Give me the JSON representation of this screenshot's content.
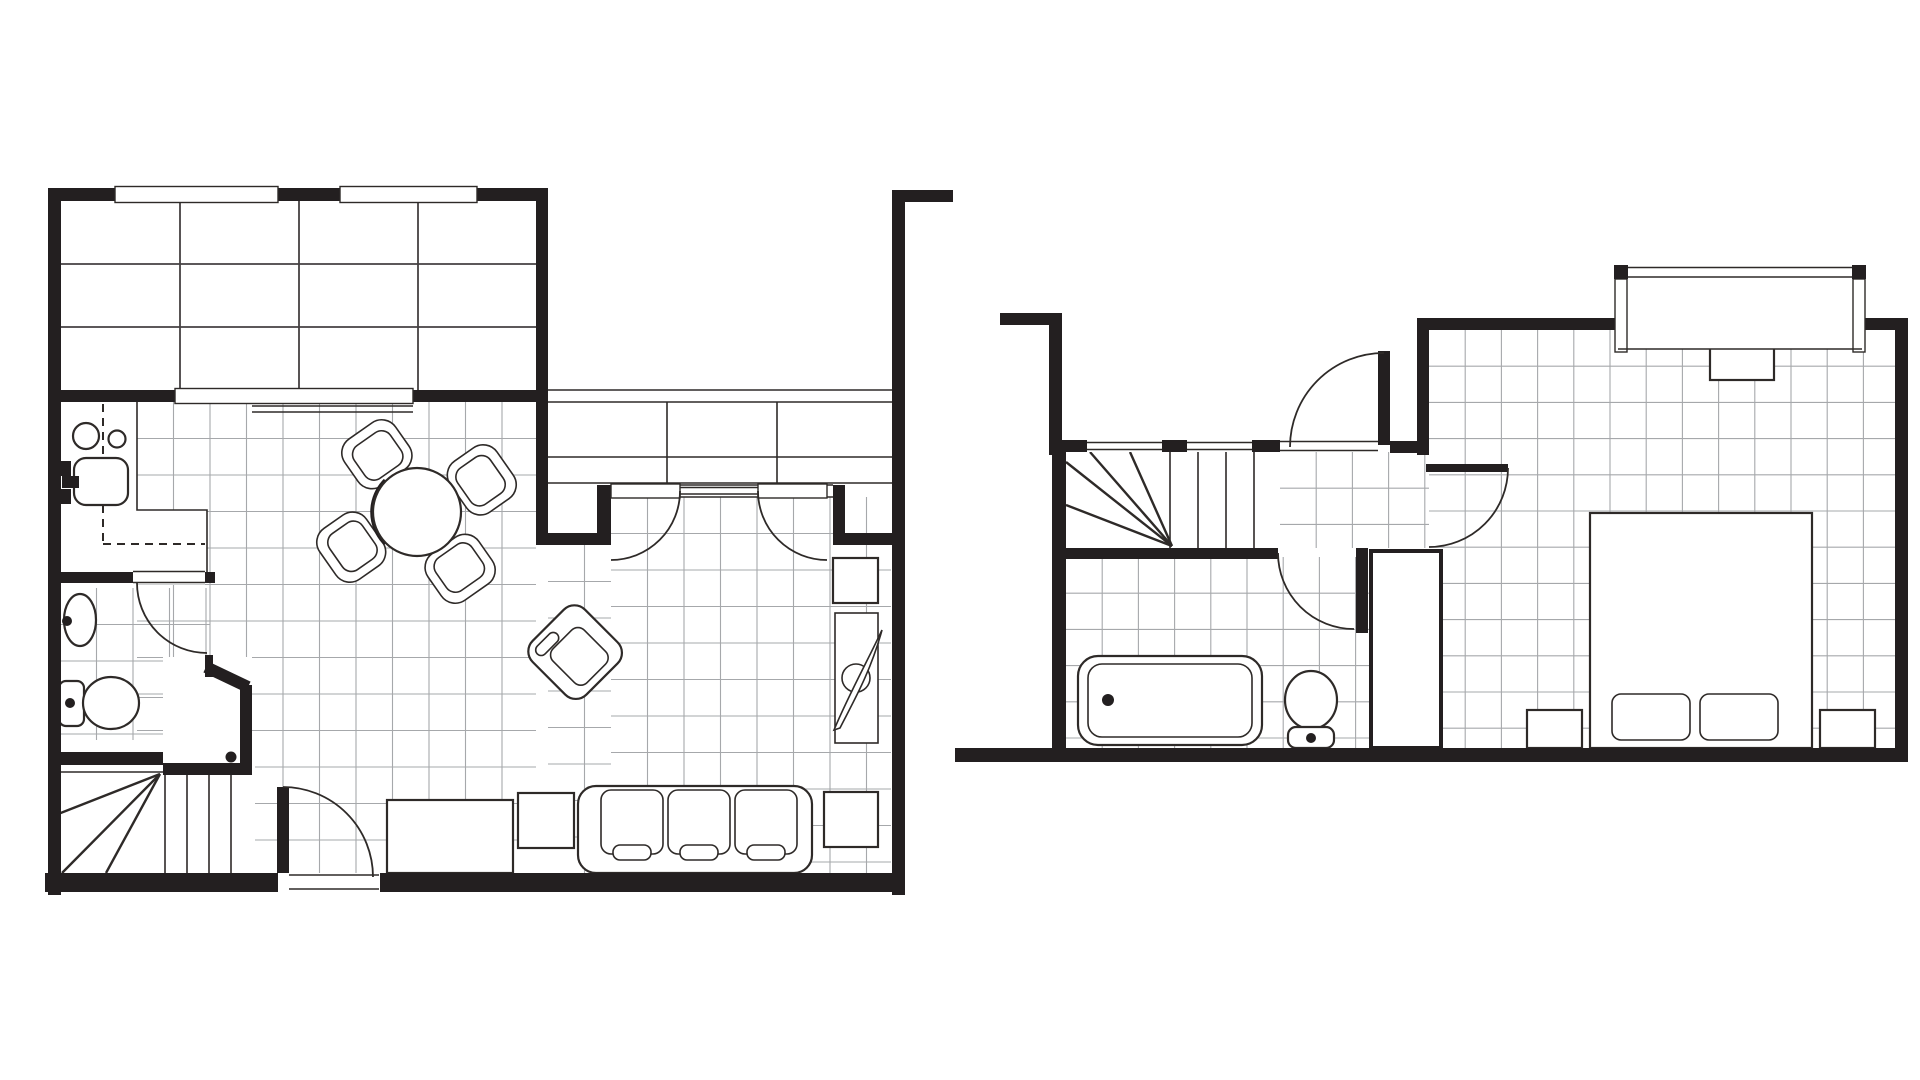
{
  "palette": {
    "background": "#ffffff",
    "wall": "#231f20",
    "line": "#2e2a28",
    "tile": "#a6a8ab",
    "patio_tile": "#454142",
    "fixture_fill": "#ffffff"
  },
  "drawing": {
    "type": "architectural-floor-plan",
    "text_labels": [],
    "floors": [
      {
        "name": "ground-floor",
        "position": "left",
        "rooms": [
          {
            "name": "deck-patio",
            "features": [
              {
                "type": "plank-tile-grid",
                "columns": 4,
                "rows": 3
              },
              {
                "type": "window",
                "count": 2
              },
              {
                "type": "serving-hatch-window",
                "count": 1
              }
            ]
          },
          {
            "name": "kitchen",
            "fixtures": [
              {
                "type": "hob-burner",
                "count": 2
              },
              {
                "type": "kitchen-sink",
                "count": 1
              },
              {
                "type": "wall-faucet",
                "count": 1
              },
              {
                "type": "dashed-appliance-outline",
                "count": 1
              }
            ]
          },
          {
            "name": "bathroom",
            "fixtures": [
              {
                "type": "pedestal-sink",
                "count": 1
              },
              {
                "type": "toilet",
                "count": 1
              },
              {
                "type": "swing-door",
                "count": 1
              }
            ]
          },
          {
            "name": "under-stair-closet",
            "fixtures": [
              {
                "type": "angled-wall",
                "count": 1
              },
              {
                "type": "door-knob-dot",
                "count": 1
              }
            ]
          },
          {
            "name": "winder-staircase",
            "fixtures": [
              {
                "type": "fan-tread",
                "count": 3
              },
              {
                "type": "straight-tread",
                "count": 3
              }
            ]
          },
          {
            "name": "living-dining-room",
            "fixtures": [
              {
                "type": "round-dining-table",
                "count": 1
              },
              {
                "type": "dining-chair",
                "count": 4
              },
              {
                "type": "rotated-armchair",
                "count": 1
              },
              {
                "type": "sofa-three-seat",
                "count": 1
              },
              {
                "type": "coffee-table",
                "count": 1
              },
              {
                "type": "end-table",
                "count": 2
              },
              {
                "type": "tv-cabinet",
                "count": 1
              },
              {
                "type": "plant-stand",
                "count": 1
              },
              {
                "type": "built-in-cabinet-row",
                "sections": 3
              },
              {
                "type": "french-door",
                "count": 2
              },
              {
                "type": "fixed-sidelight",
                "count": 1
              }
            ]
          },
          {
            "name": "entry",
            "fixtures": [
              {
                "type": "entrance-door",
                "count": 1
              }
            ]
          }
        ]
      },
      {
        "name": "upper-floor",
        "position": "right",
        "rooms": [
          {
            "name": "staircase",
            "fixtures": [
              {
                "type": "fan-tread",
                "count": 4
              },
              {
                "type": "straight-tread",
                "count": 3
              },
              {
                "type": "window",
                "count": 2
              }
            ]
          },
          {
            "name": "landing-hall",
            "fixtures": [
              {
                "type": "entry-door",
                "count": 1
              },
              {
                "type": "closet-door",
                "count": 1
              }
            ]
          },
          {
            "name": "bathroom",
            "fixtures": [
              {
                "type": "bathtub",
                "count": 1
              },
              {
                "type": "toilet",
                "count": 1
              },
              {
                "type": "swing-door",
                "count": 1
              },
              {
                "type": "built-in-cabinet",
                "count": 1
              }
            ]
          },
          {
            "name": "bedroom",
            "fixtures": [
              {
                "type": "double-bed",
                "count": 1
              },
              {
                "type": "pillow",
                "count": 2
              },
              {
                "type": "nightstand",
                "count": 2
              },
              {
                "type": "dresser",
                "count": 1
              },
              {
                "type": "window-bay",
                "count": 1
              }
            ]
          }
        ]
      }
    ]
  }
}
